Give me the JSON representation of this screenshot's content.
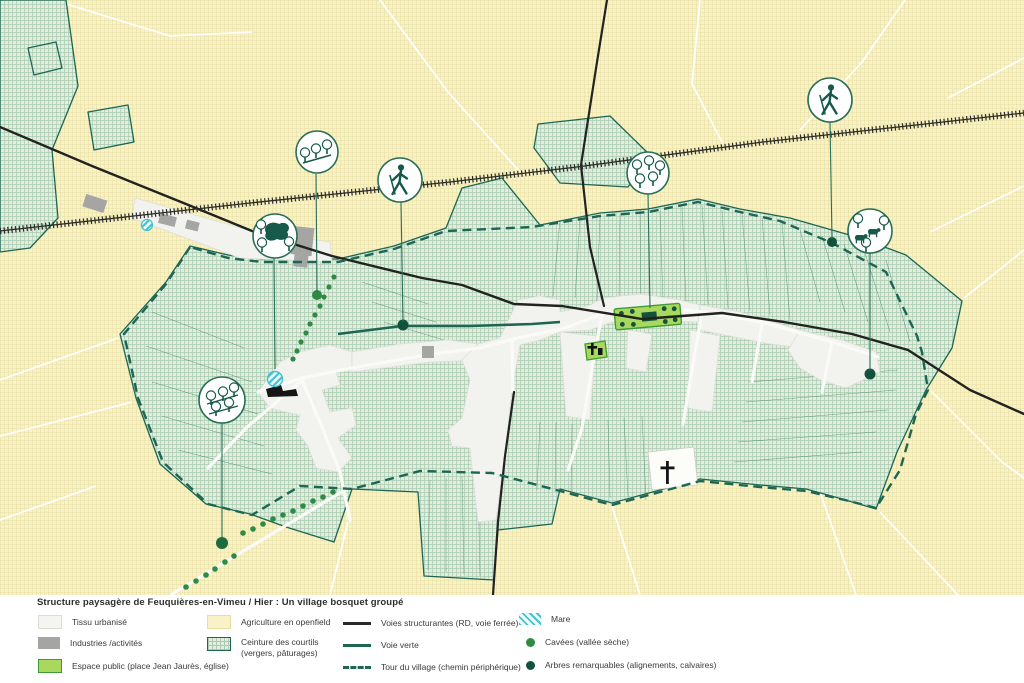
{
  "legend": {
    "title": "Structure paysagère de Feuquières-en-Vimeu / Hier : Un village bosquet groupé",
    "areas": [
      {
        "label": "Tissu urbanisé"
      },
      {
        "label": "Industries /activités"
      },
      {
        "label": "Espace public (place Jean Jaurès, église)"
      },
      {
        "label": "Agriculture en openfield"
      },
      {
        "label": "Ceinture des courtils",
        "label2": "(vergers, pâturages)"
      }
    ],
    "lines": [
      {
        "label": "Voies structurantes (RD, voie ferrée)"
      },
      {
        "label": "Voie verte"
      },
      {
        "label": "Tour du village (chemin périphérique)"
      }
    ],
    "points": [
      {
        "label": "Mare"
      },
      {
        "label": "Cavées (vallée sèche)"
      },
      {
        "label": "Arbres remarquables (alignements, calvaires)"
      }
    ]
  },
  "colors": {
    "openfield": "#f8f2c6",
    "openfield_grid": "#eae0a4",
    "courtils_fill": "#e4eddd",
    "courtils_grid": "#a9ccb2",
    "courtils_border": "#1c6653",
    "urban": "#f2f2ee",
    "industry": "#a5a5a3",
    "public_space": "#a8d85e",
    "public_space_border": "#3f9b35",
    "road": "#222220",
    "green_way": "#1c6653",
    "mare": "#45c2d2",
    "cavee_dot": "#2f8b43",
    "tree_dot": "#11523d"
  },
  "map_icons": {
    "callouts": [
      "aligned-trees",
      "walker",
      "orchard-trees",
      "walker",
      "pasture-cows",
      "grove-trees",
      "orchard-rows"
    ],
    "symbols": [
      "mare-pond",
      "church-cross",
      "calvary-cross",
      "industry-building"
    ]
  }
}
